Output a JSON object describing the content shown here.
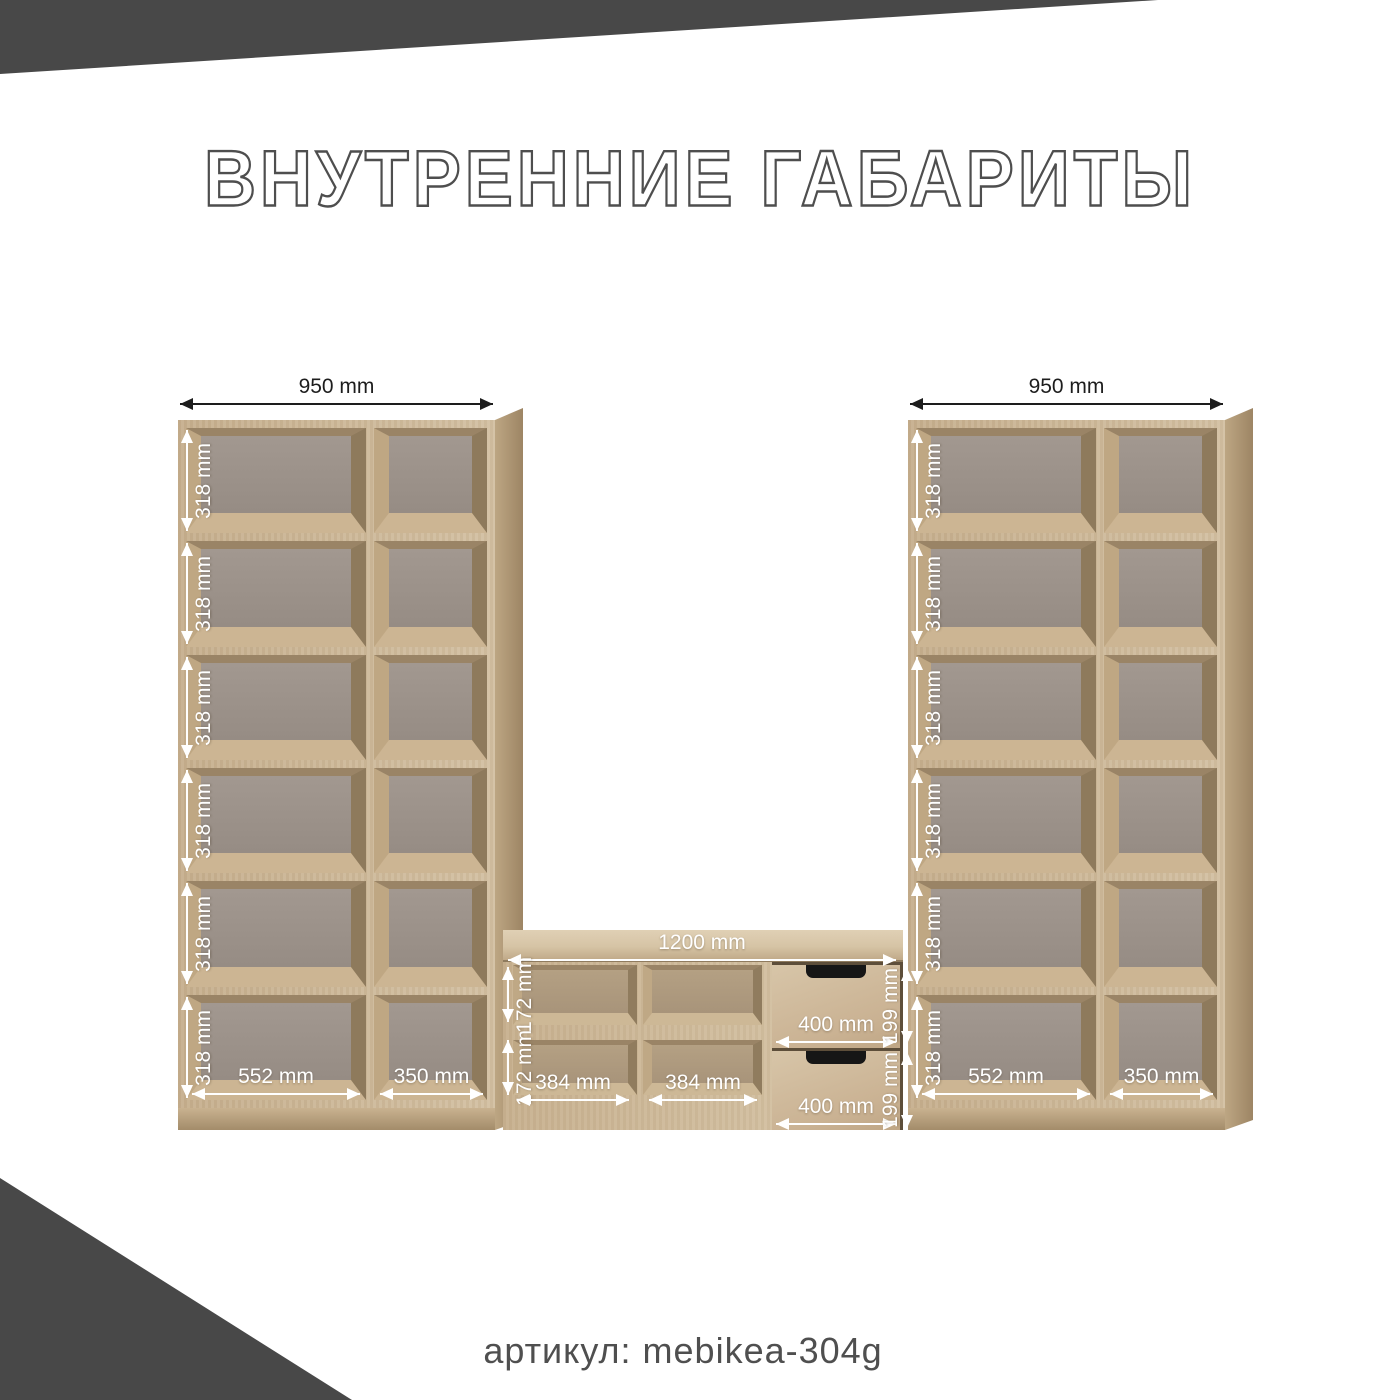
{
  "title": "ВНУТРЕННИЕ ГАБАРИТЫ",
  "footer": {
    "article_label": "артикул: mebikea-304g"
  },
  "left_bookcase": {
    "width_label": "950 mm",
    "row_labels": [
      "318 mm",
      "318 mm",
      "318 mm",
      "318 mm",
      "318 mm",
      "318 mm"
    ],
    "bottom_labels": [
      "552 mm",
      "350 mm"
    ]
  },
  "right_bookcase": {
    "width_label": "950 mm",
    "row_labels": [
      "318 mm",
      "318 mm",
      "318 mm",
      "318 mm",
      "318 mm",
      "318 mm"
    ],
    "bottom_labels": [
      "552 mm",
      "350 mm"
    ]
  },
  "tv_stand": {
    "width_label": "1200 mm",
    "row_labels": [
      "172 mm",
      "172 mm"
    ],
    "compartment_labels": [
      "384 mm",
      "384 mm"
    ],
    "drawer_width_labels": [
      "400 mm",
      "400 mm"
    ],
    "drawer_height_labels": [
      "199 mm",
      "199 mm"
    ]
  },
  "colors": {
    "accent_dark": "#484848",
    "title_outline": "#4e4e4e",
    "wood_light": "#d3c0a2",
    "wood_medium": "#b59d7a",
    "wood_dark": "#8e7a5c",
    "back_panel": "#9a9088",
    "dim_text_white": "#ffffff",
    "dim_text_black": "#1d1d1d",
    "drawer_handle": "#161616"
  }
}
